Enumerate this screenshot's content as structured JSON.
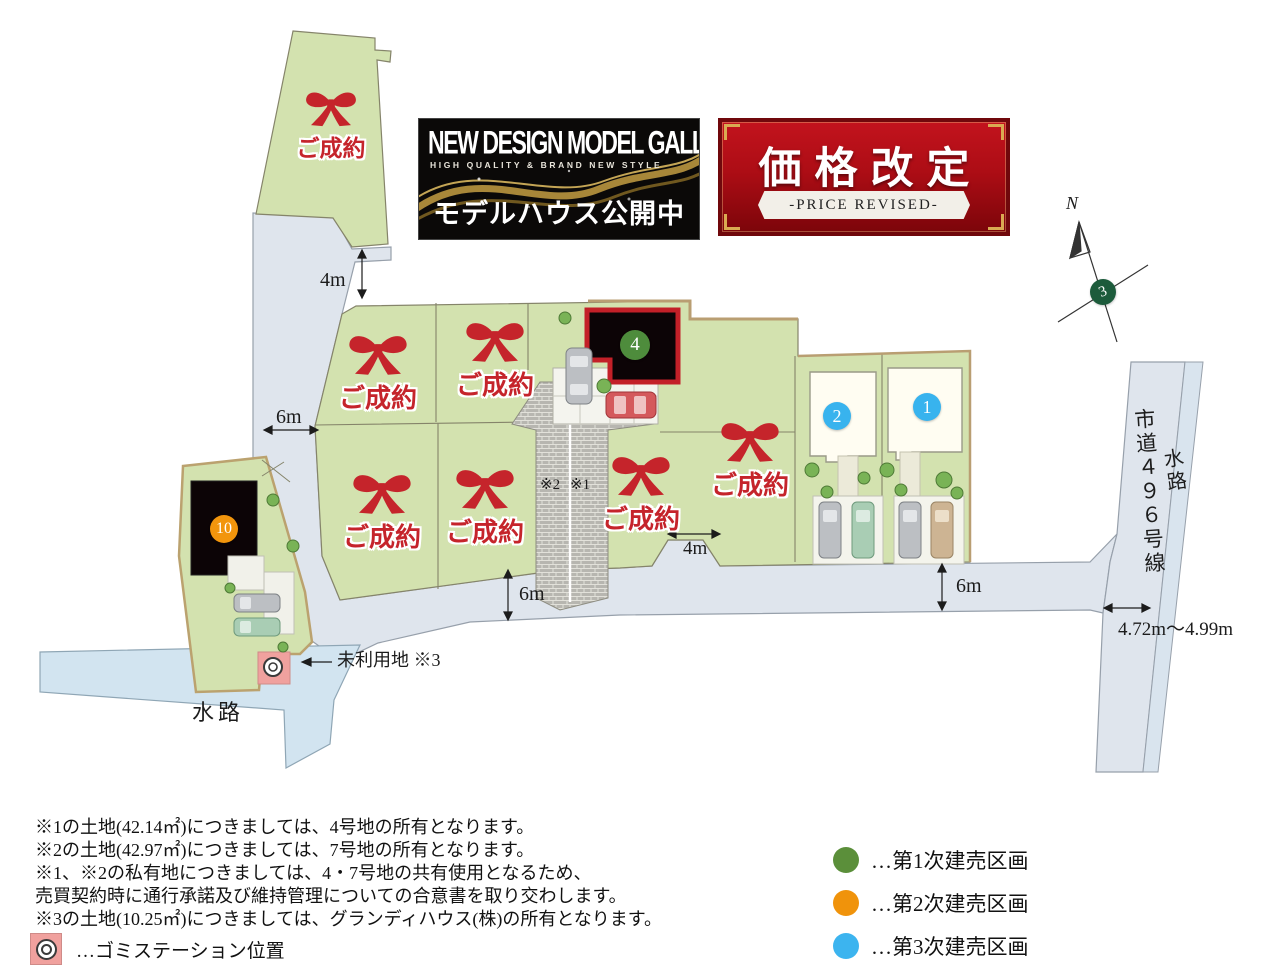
{
  "banners": {
    "gallery": {
      "title": "NEW DESIGN MODEL GALLERY",
      "subtitle": "HIGH QUALITY & BRAND NEW STYLE",
      "caption": "モデルハウス公開中"
    },
    "price": {
      "title": "価格改定",
      "subtitle": "-PRICE REVISED-"
    }
  },
  "compass": {
    "north": "N",
    "point_label": "3"
  },
  "map": {
    "sold_label": "ご成約",
    "lots": {
      "no1": "1",
      "no2": "2",
      "no4": "4",
      "no10": "10"
    },
    "measurements": {
      "top_gap": "4m",
      "west_road": "6m",
      "driveway": "4m",
      "south_road_west": "6m",
      "south_road_east": "6m",
      "east_road_width": "4.72m〜4.99m"
    },
    "labels": {
      "private2": "※2",
      "private1": "※1",
      "unused": "未利用地 ※3",
      "canal_south": "水路",
      "canal_east": "水路",
      "city_road": "市道４９６号線"
    }
  },
  "notes": {
    "line1": "※1の土地(42.14㎡)につきましては、4号地の所有となります。",
    "line2": "※2の土地(42.97㎡)につきましては、7号地の所有となります。",
    "line3": "※1、※2の私有地につきましては、4・7号地の共有使用となるため、",
    "line4": "売買契約時に通行承諾及び維持管理についての合意書を取り交わします。",
    "line5": "※3の土地(10.25㎡)につきましては、グランディハウス(株)の所有となります。"
  },
  "legend": {
    "garbage_label": "…ゴミステーション位置",
    "items": [
      {
        "color": "#5b8f3a",
        "label": "…第1次建売区画"
      },
      {
        "color": "#f0930b",
        "label": "…第2次建売区画"
      },
      {
        "color": "#3cb4ef",
        "label": "…第3次建売区画"
      }
    ]
  },
  "colors": {
    "lot_green": "#d3e2af",
    "road": "#dfe5ed",
    "canal": "#d2e4f0",
    "sold_red": "#c5242b",
    "phase1_green": "#4e8c3c",
    "phase2_orange": "#f2950c",
    "phase3_blue": "#38b3ee"
  }
}
